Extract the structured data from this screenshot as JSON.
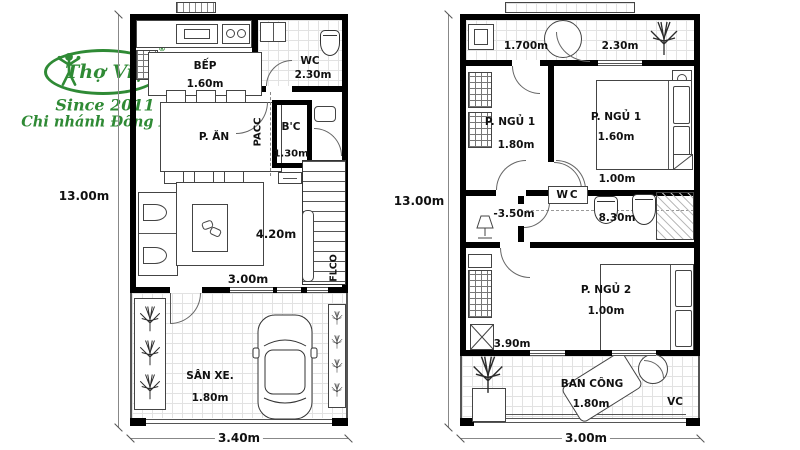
{
  "theme": {
    "logo_green": "#2f8a35",
    "wall_color": "#000000",
    "line_color": "#444444",
    "tile": "#e2e2e2"
  },
  "logo": {
    "brand": "Thợ Việt",
    "registered": "®",
    "since": "Since 2011",
    "branch": "Chi nhánh Đồng Nai"
  },
  "floor1": {
    "dim_left": "13.00m",
    "dim_bottom": "3.40m",
    "kitchen": {
      "label": "BẾP",
      "dim": "1.60m"
    },
    "wc": {
      "label": "WC",
      "dim": "2.30m"
    },
    "dining": {
      "label": "P. ĂN"
    },
    "shaft": {
      "label": "PACC"
    },
    "storage": {
      "label": "B'C",
      "dim": "1.30m"
    },
    "stairs": {
      "dim": "4.20m"
    },
    "living": {
      "dim": "3.00m"
    },
    "flco": {
      "label": "FLCO"
    },
    "garage": {
      "label": "SÂN XE.",
      "dim": "1.80m"
    }
  },
  "floor2": {
    "dim_left": "13.00m",
    "dim_bottom": "3.00m",
    "laundry": {
      "dim1": "1.700m",
      "dim2": "2.30m"
    },
    "bedroom1_left": {
      "label": "P. NGỦ 1",
      "dim": "1.80m"
    },
    "bedroom1_right": {
      "label": "P. NGỦ 1",
      "dim": "1.60m",
      "dim2": "1.00m"
    },
    "hall": {
      "dim": "-3.50m"
    },
    "wc": {
      "label": "WC",
      "dim": "8.30m"
    },
    "bedroom2": {
      "label": "P. NGỦ 2",
      "dim": "1.00m",
      "dim2": "3.90m"
    },
    "balcony": {
      "label": "BAN CÔNG",
      "dim": "1.80m",
      "corner_label": "VC"
    }
  }
}
